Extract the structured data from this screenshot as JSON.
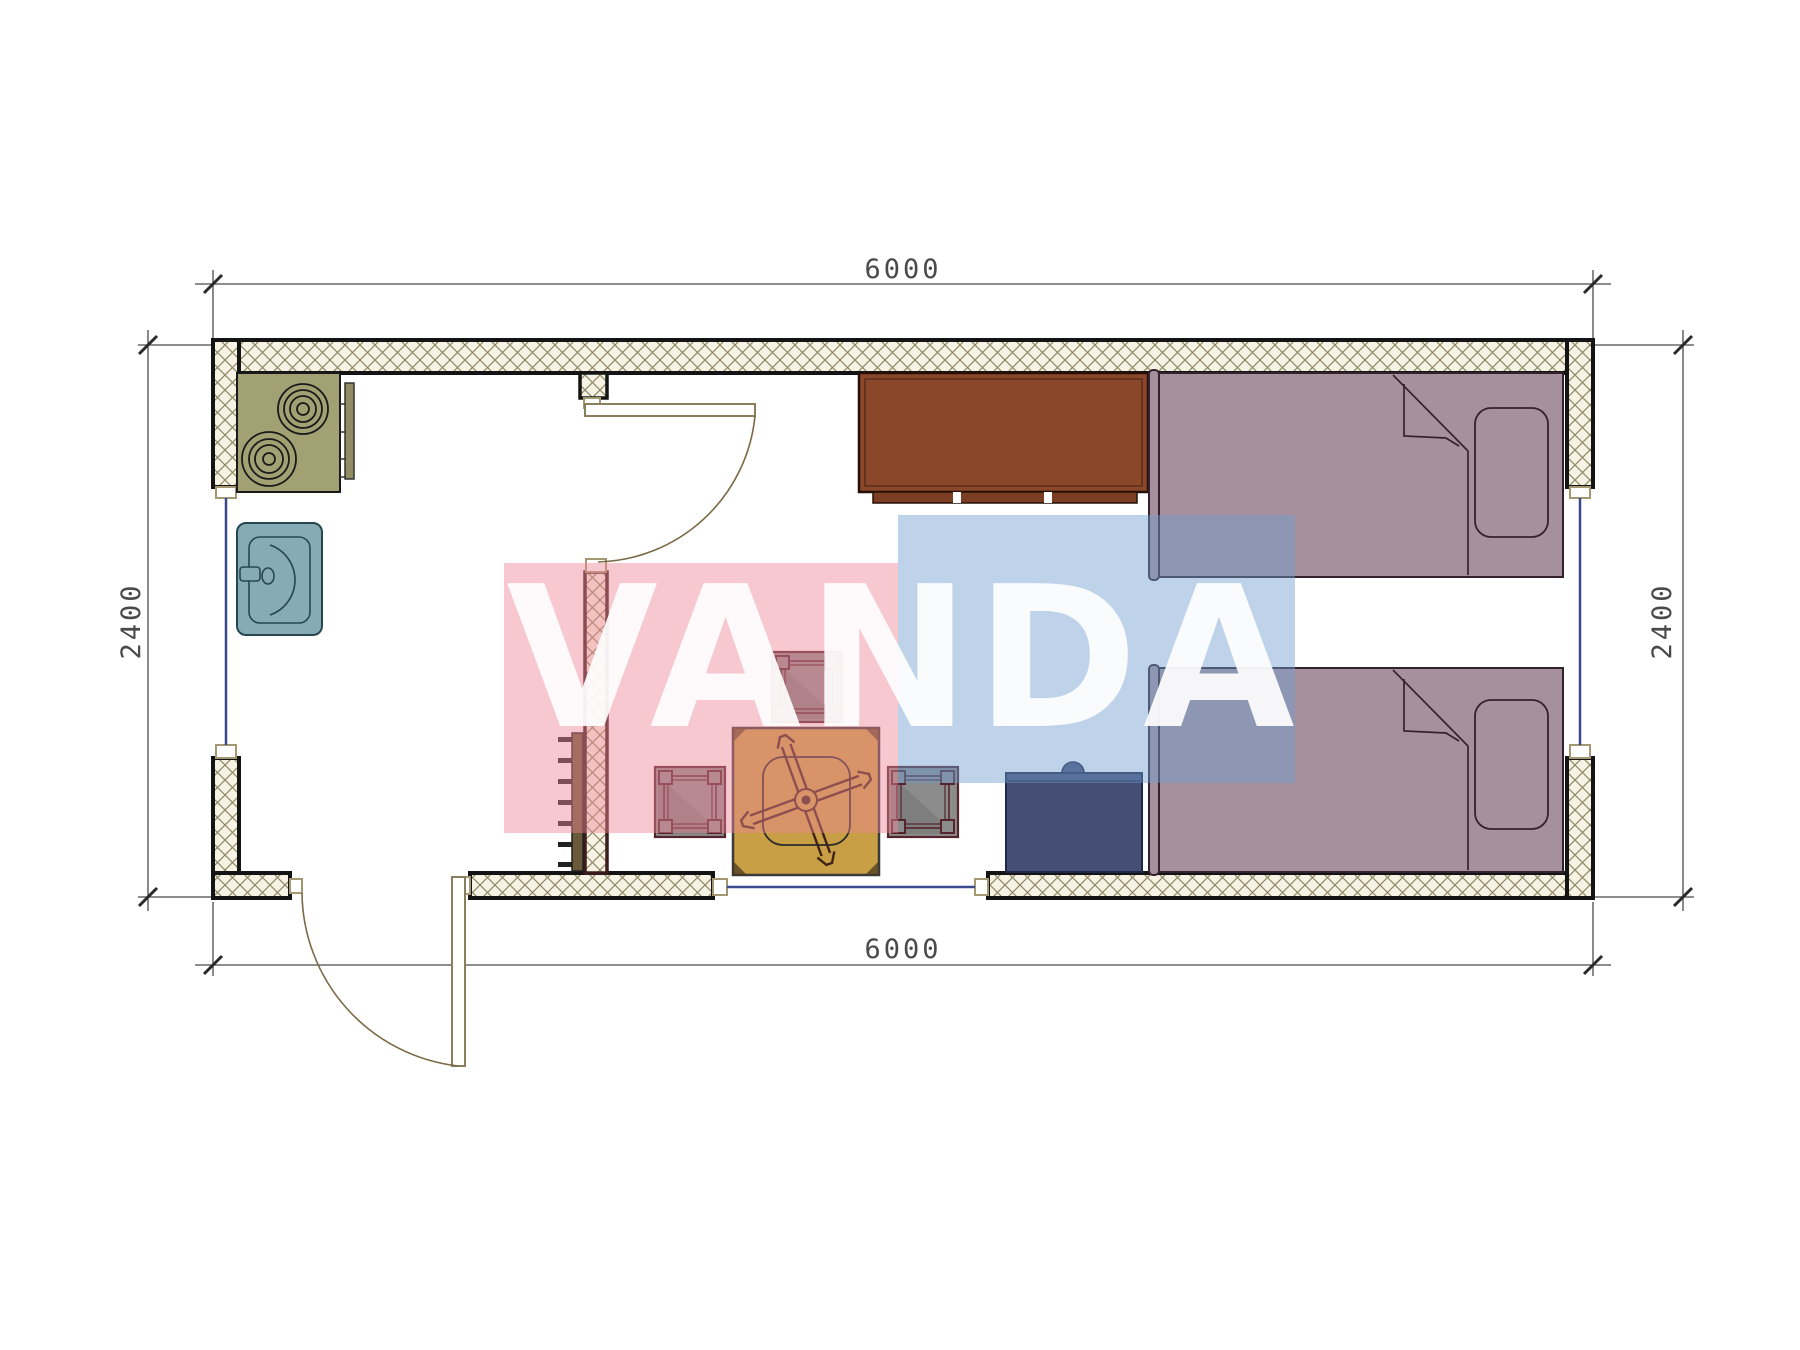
{
  "drawing": {
    "kind": "container-house floor plan, twin-bed room with kitchenette",
    "dimensions": {
      "top": "6000",
      "bottom": "6000",
      "left": "2400",
      "right": "2400"
    },
    "watermark": {
      "text": "VANDA"
    }
  },
  "colors": {
    "wall_hatch_bg": "#f6f2e4",
    "wall_hatch_line": "#8f8865",
    "wall_edge": "#141414",
    "partition_edge": "#3a1c1c",
    "window": "#3a4a8e",
    "door": "#8a7f5c",
    "stove": "#a2a173",
    "stove_handle": "#8f8c66",
    "sink": "#87abb5",
    "sink_line": "#274750",
    "cabinet": "#8a4729",
    "cabinet_kick": "#7c3e22",
    "bed": "#a6909d",
    "bed_line": "#33222e",
    "nightstand": "#454f76",
    "nightstand_line": "#1e2747",
    "table": "#c99f45",
    "table_line": "#3f2218",
    "stool": "#8c8c8c",
    "stool_frame": "#55242c",
    "radiator": "#6b5a3a",
    "watermark_pink": "#ed8494",
    "watermark_blue": "#6f9dce",
    "dim_text": "#4a4a4a"
  },
  "furniture_icons": [
    "stove-icon",
    "sink-icon",
    "wardrobe-cabinet-icon",
    "bed-icon",
    "bed-icon",
    "nightstand-icon",
    "dining-table-icon",
    "stool-icon",
    "stool-icon",
    "stool-icon",
    "radiator-icon",
    "door-swing-icon",
    "door-swing-icon",
    "window-icon",
    "window-icon",
    "window-icon"
  ]
}
